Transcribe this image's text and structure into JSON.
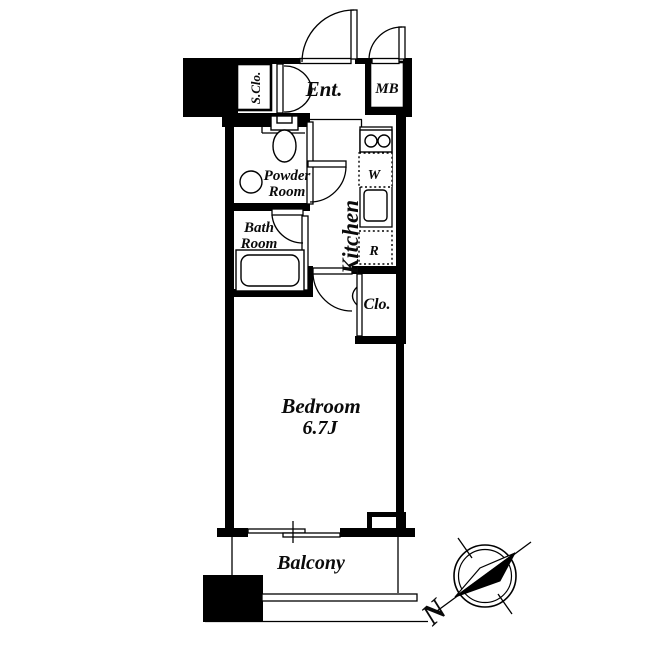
{
  "rooms": {
    "shoe_closet": "S.Clo.",
    "entrance": "Ent.",
    "meter_box": "MB",
    "powder_room": [
      "Powder",
      "Room"
    ],
    "bath_room": [
      "Bath",
      "Room"
    ],
    "kitchen": "Kitchen",
    "washer": "W",
    "refrigerator": "R",
    "closet": "Clo.",
    "bedroom": "Bedroom",
    "bedroom_area": "6.7J",
    "balcony": "Balcony"
  },
  "compass": {
    "north": "N"
  },
  "colors": {
    "wall": "#000000",
    "background": "#ffffff"
  }
}
